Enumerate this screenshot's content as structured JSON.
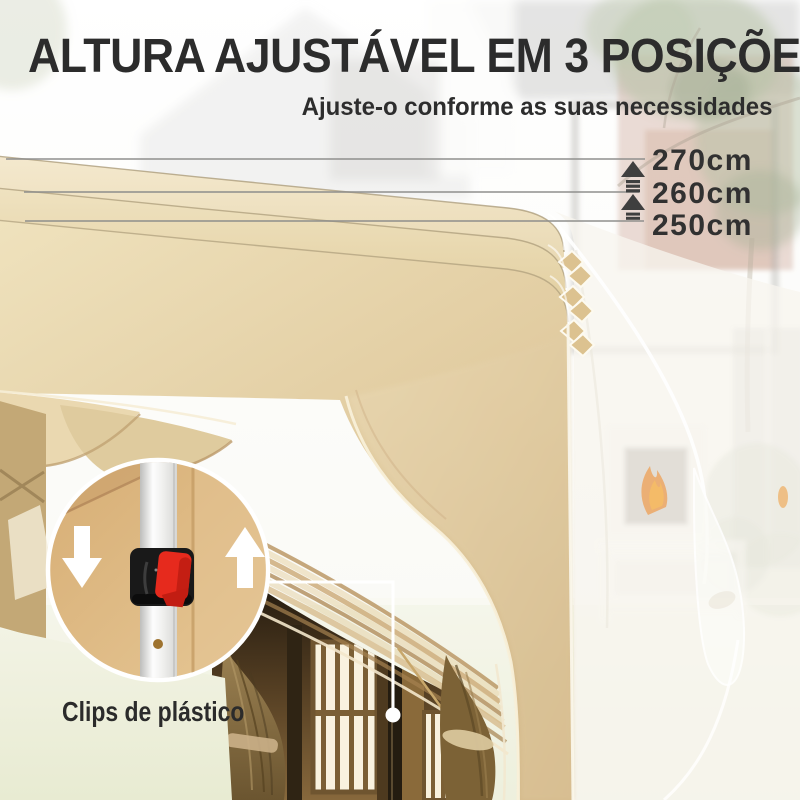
{
  "title": "ALTURA AJUSTÁVEL EM 3 POSIÇÕES",
  "subtitle": "Ajuste-o conforme as suas necessidades",
  "heights": [
    {
      "label": "270cm"
    },
    {
      "label": "260cm"
    },
    {
      "label": "250cm"
    }
  ],
  "callout": {
    "label": "Clips de plástico"
  },
  "icons": {
    "raise_arrow": "up-arrow-striped",
    "clip_lower": "down-arrow",
    "clip_raise": "up-arrow"
  },
  "colors": {
    "text": "#2c2c2c",
    "measure_line": "#8e8e8c",
    "canopy_light": "#f2e7cb",
    "canopy_main": "#e2cda2",
    "canopy_dark": "#d5bb8c",
    "clip_body": "#191919",
    "clip_lever_red": "#e62a1d",
    "pole_white": "#f4f4f2",
    "fabric_tan": "#d9b27c",
    "grass": "#edefdb",
    "ghost_white": "#f7f5ee"
  }
}
